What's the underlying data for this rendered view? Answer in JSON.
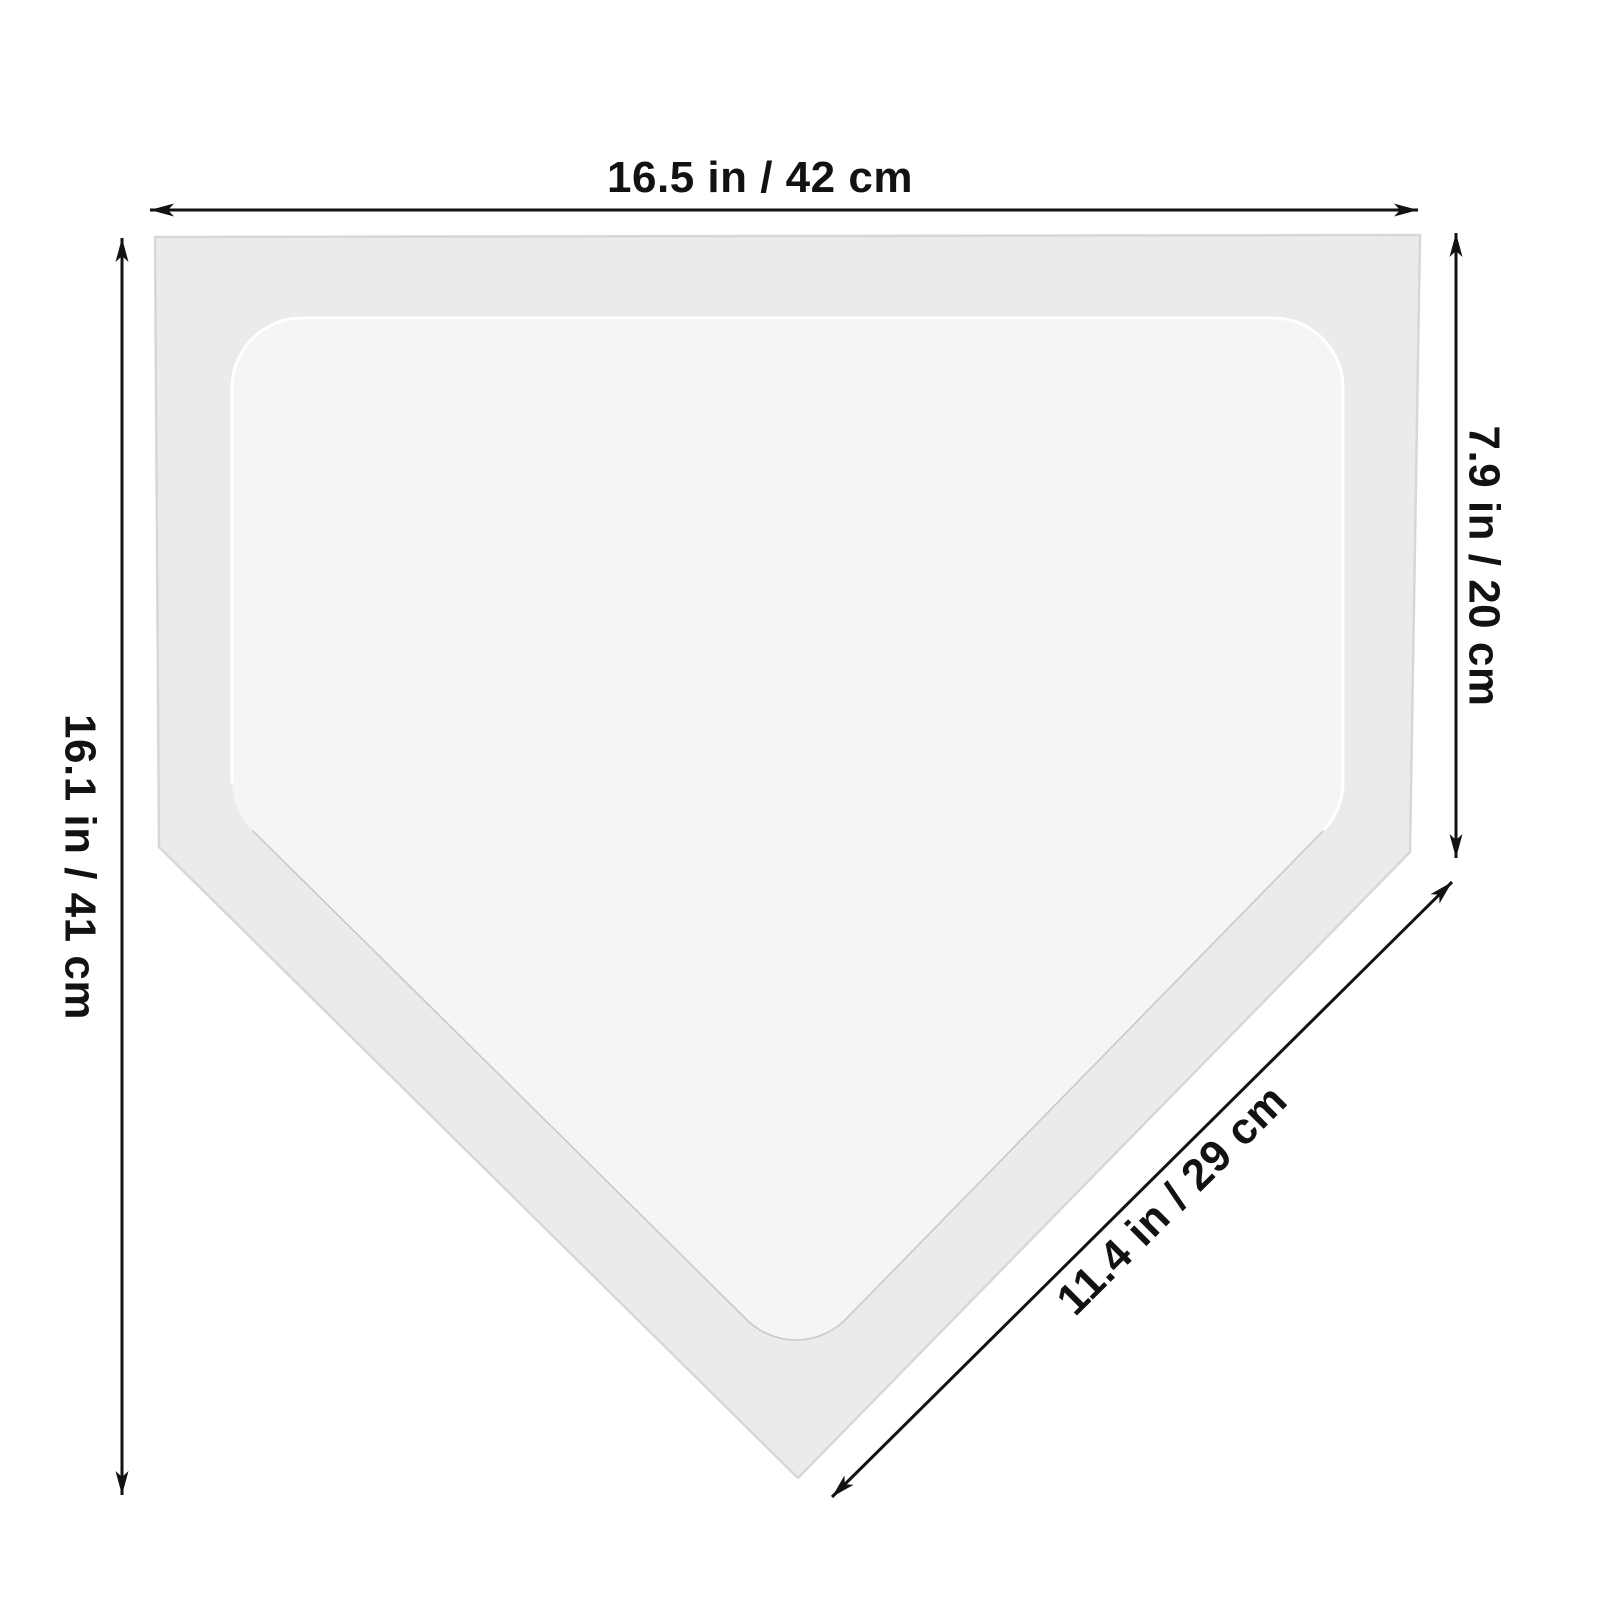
{
  "diagram": {
    "type": "product-dimension-diagram",
    "subject": "baseball home plate",
    "labels": {
      "top_width": "16.5 in / 42 cm",
      "left_height": "16.1 in / 41 cm",
      "right_side": "7.9 in / 20 cm",
      "bottom_right_diagonal": "11.4 in / 29 cm"
    },
    "measurements": [
      {
        "edge": "top width",
        "inches": 16.5,
        "cm": 42
      },
      {
        "edge": "left overall height",
        "inches": 16.1,
        "cm": 41
      },
      {
        "edge": "right straight side",
        "inches": 7.9,
        "cm": 20
      },
      {
        "edge": "bottom-right diagonal side",
        "inches": 11.4,
        "cm": 29
      }
    ],
    "colors": {
      "background": "#ffffff",
      "plate_outer_fill": "#ebebeb",
      "plate_outer_stroke": "#d7d7d7",
      "plate_inner_fill": "#f5f5f5",
      "plate_inner_highlight": "#ffffff",
      "plate_inner_shadow": "#c9c9c9",
      "dimension_line": "#121212",
      "label_text": "#121212"
    }
  }
}
